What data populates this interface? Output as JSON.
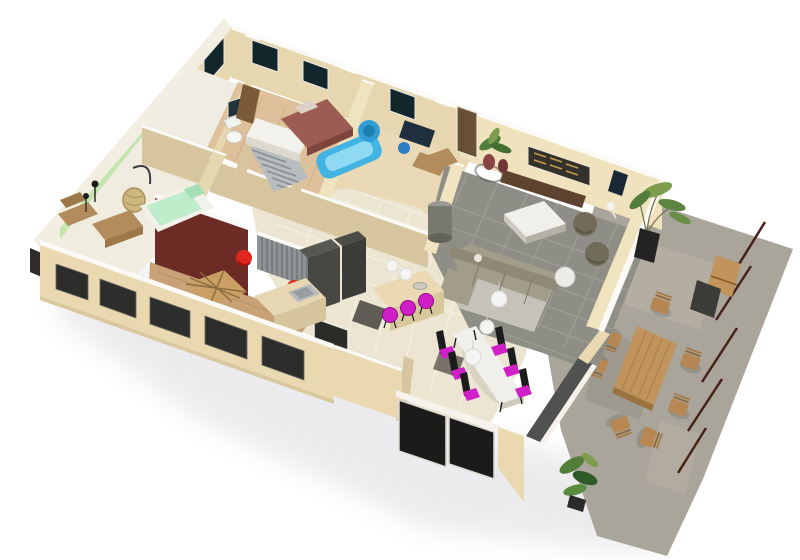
{
  "meta": {
    "description": "3D dollhouse-style cutaway rendering of a furnished single-storey house floor plan with an outdoor stone terrace, viewed from above at an angle on a white background",
    "view": "aerial axonometric cutaway"
  },
  "palette": {
    "bg": "#ffffff",
    "shadow": "#e6e6e9",
    "wall_outer": "#e9d8b0",
    "wall_top": "#fbfaf6",
    "wall_inner": "#e7d7b1",
    "wall_inner_light": "#f0e3bf",
    "wall_inner_dark": "#d6c59e",
    "wall_white": "#f2eee2",
    "green_wall": "#c4e6ae",
    "green_wall_dark": "#a9d494",
    "maroon_wall": "#6d2b26",
    "floor_wood": "#c8a276",
    "floor_wood_light": "#dec19a",
    "floor_pale": "#e9d9b6",
    "floor_cream": "#ece5d2",
    "floor_green_room": "#f0ecdf",
    "tile_grey": "#8e8e86",
    "tile_grout": "#a3a39b",
    "rug": "#cbc9bf",
    "terrace": "#a9a59a",
    "terrace_light": "#bcb6a8",
    "terrace_dark": "#948f83",
    "railing": "#47221a",
    "window_dark": "#13262c",
    "shutter_dark": "#2d2d2b",
    "glass_black": "#1b1b19",
    "door_brown": "#6b5138",
    "door_int": "#7b5a38",
    "wood_furn": "#b28c5c",
    "wood_furn_dark": "#9d7848",
    "wood_deck": "#c0945c",
    "wood_deck_dark": "#a37a42",
    "chair_wood": "#b68753",
    "sofa": "#a29c8a",
    "sofa_dark": "#8e8876",
    "table_white": "#f0efeb",
    "table_side": "#b5b1a8",
    "pouf": "#716c5a",
    "tv_bench": "#5e4430",
    "art_dark": "#34302a",
    "art_gold": "#c39a4e",
    "magenta": "#d01fc6",
    "magenta_dark": "#8e0d88",
    "red": "#e42620",
    "blue": "#42b4e4",
    "blue_light": "#8fd9f2",
    "blue_dark": "#2f9fd6",
    "navy": "#1f2f3f",
    "chair_blue": "#2e7cc4",
    "bed_maroon": "#9c5c54",
    "bed_maroon_dark": "#7e453f",
    "mint": "#bfeccb",
    "mint_dark": "#a5e0b5",
    "white_soft": "#f3f1eb",
    "steel": "#b7babd",
    "steel_dark": "#989da0",
    "dark_unit": "#474743",
    "dark_unit2": "#3b3b37",
    "stair_grey": "#b9bdc0",
    "stair_line": "#878d92",
    "ribbed": "#8f9396",
    "ribbed_line": "#6e7276",
    "cyl": "#79786f",
    "cyl_top": "#9a9992",
    "plant": "#527d3a",
    "plant_dark": "#2f5a28",
    "plant_light": "#7d9c4e",
    "pot_black": "#232321",
    "vase": "#8a4343",
    "lamp_white": "#f4f4f2",
    "black": "#1c1c1c",
    "grey_band": "#515150"
  },
  "rooms": [
    {
      "name": "living-room",
      "floor": "grey tile"
    },
    {
      "name": "dining-area",
      "floor": "cream tile"
    },
    {
      "name": "kitchen",
      "floor": "cream tile"
    },
    {
      "name": "hallway",
      "floor": "cream tile"
    },
    {
      "name": "green-bedroom",
      "walls": "pale green"
    },
    {
      "name": "red-accent-room",
      "walls": "dark maroon"
    },
    {
      "name": "master-bedroom",
      "floor": "light wood"
    },
    {
      "name": "bathroom",
      "fixtures": "blue bathtub and shower"
    },
    {
      "name": "wc",
      "fixtures": "toilet"
    },
    {
      "name": "terrace",
      "floor": "stone paving"
    }
  ],
  "counts": {
    "dining_chairs": 6,
    "bar_stools": 3,
    "terrace_chairs": 7,
    "pendant_lamps": 5,
    "front_shutter_windows": 5,
    "back_wall_windows": 3,
    "railing_segments": 5,
    "red_chairs": 2,
    "plants": 4
  }
}
